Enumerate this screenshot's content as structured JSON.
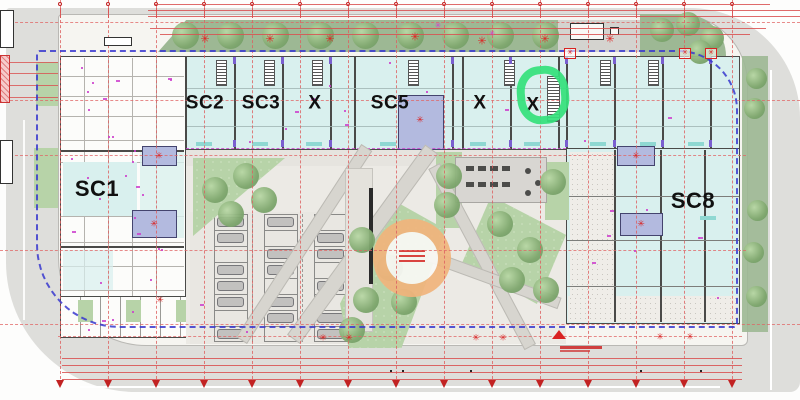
{
  "plan": {
    "description": "architectural site plan with commercial units, central plaza, parking and perimeter roads",
    "unit_labels": [
      {
        "id": "sc1",
        "text": "SC1",
        "x": 97,
        "y": 189,
        "size": 22
      },
      {
        "id": "sc2",
        "text": "SC2",
        "x": 205,
        "y": 103,
        "size": 19
      },
      {
        "id": "sc3",
        "text": "SC3",
        "x": 261,
        "y": 103,
        "size": 19
      },
      {
        "id": "x4",
        "text": "X",
        "x": 315,
        "y": 103,
        "size": 19
      },
      {
        "id": "sc5",
        "text": "SC5",
        "x": 390,
        "y": 103,
        "size": 19
      },
      {
        "id": "x6",
        "text": "X",
        "x": 480,
        "y": 103,
        "size": 19
      },
      {
        "id": "x7",
        "text": "X",
        "x": 533,
        "y": 105,
        "size": 19
      },
      {
        "id": "sc8",
        "text": "SC8",
        "x": 693,
        "y": 201,
        "size": 22
      }
    ],
    "annotations": {
      "highlight_ring": {
        "meaning": "hand-drawn green marker ring around unit X",
        "x": 517,
        "y": 66,
        "width": 52,
        "height": 58,
        "color": "#35e17c"
      },
      "play_circle": {
        "meaning": "orange circular plaza feature with small red caption lines",
        "x": 373,
        "y": 219,
        "diameter": 78,
        "ring_color": "#f1b47c",
        "caption_line_count": 3
      }
    },
    "icons": {
      "hydrant": "✳",
      "flower": "✳",
      "sprout": "✳"
    },
    "colors": {
      "road": "#dededb",
      "site": "#f6f5f1",
      "unit_fill": "#d9f0ee",
      "wall": "#4a4a48",
      "landscape_band": "#9db894",
      "plaza_green": "#b7d3a8",
      "tree": "#7fa76e",
      "boundary_blue": "#3939cf",
      "grid_red": "#dd5f5f",
      "detail_magenta": "#cc3fcc",
      "core_purple": "#b3badf",
      "symbol_red": "#d92222",
      "paving": "#eceae5",
      "path": "#d7d5cf"
    }
  }
}
